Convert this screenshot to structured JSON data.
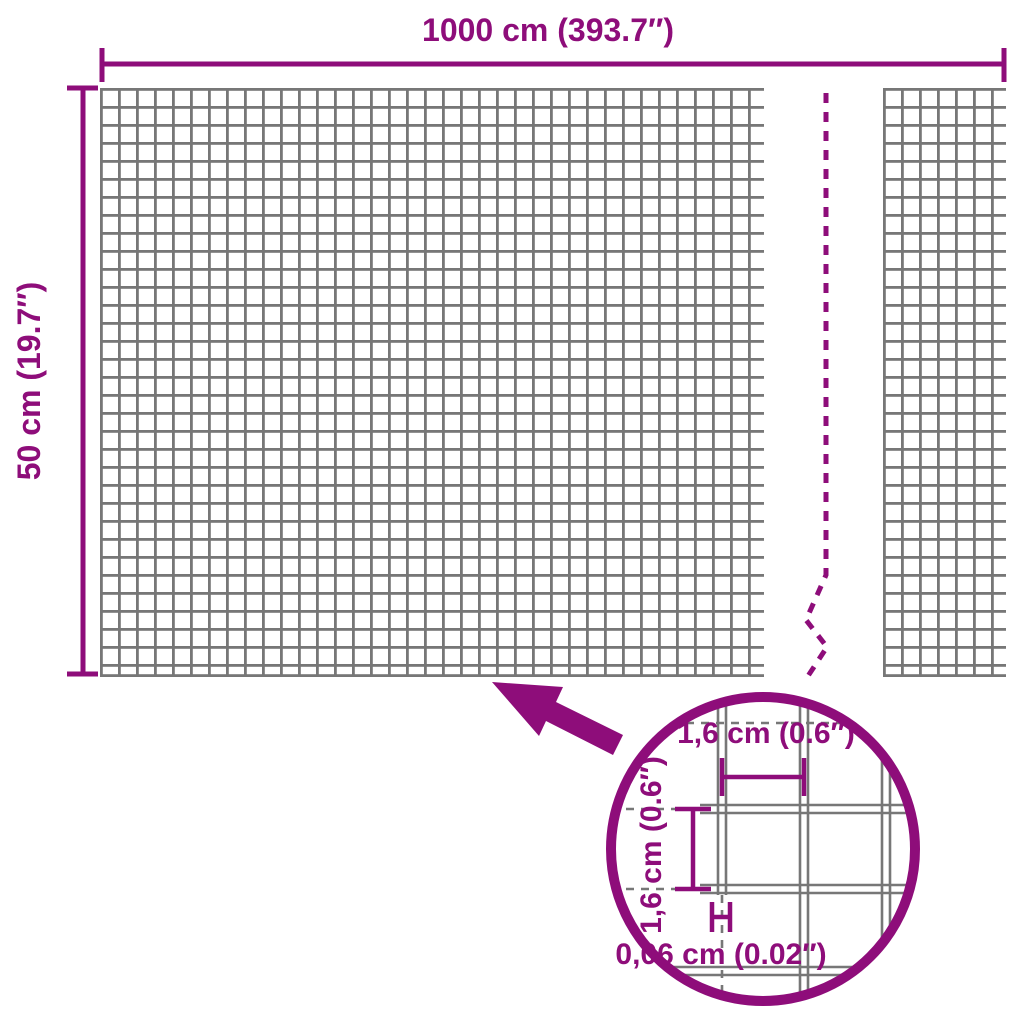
{
  "diagram": {
    "top_dimension": {
      "label": "1000 cm (393.7″)"
    },
    "side_dimension": {
      "label": "50 cm (19.7″)"
    },
    "detail": {
      "mesh_width": {
        "label": "1,6 cm (0.6″)"
      },
      "mesh_height": {
        "label": "1,6 cm (0.6″)"
      },
      "wire_thickness": {
        "label": "0,06 cm (0.02″)"
      }
    },
    "colors": {
      "accent": "#8e0d7a",
      "mesh_gray": "#777777",
      "background": "#ffffff"
    }
  }
}
